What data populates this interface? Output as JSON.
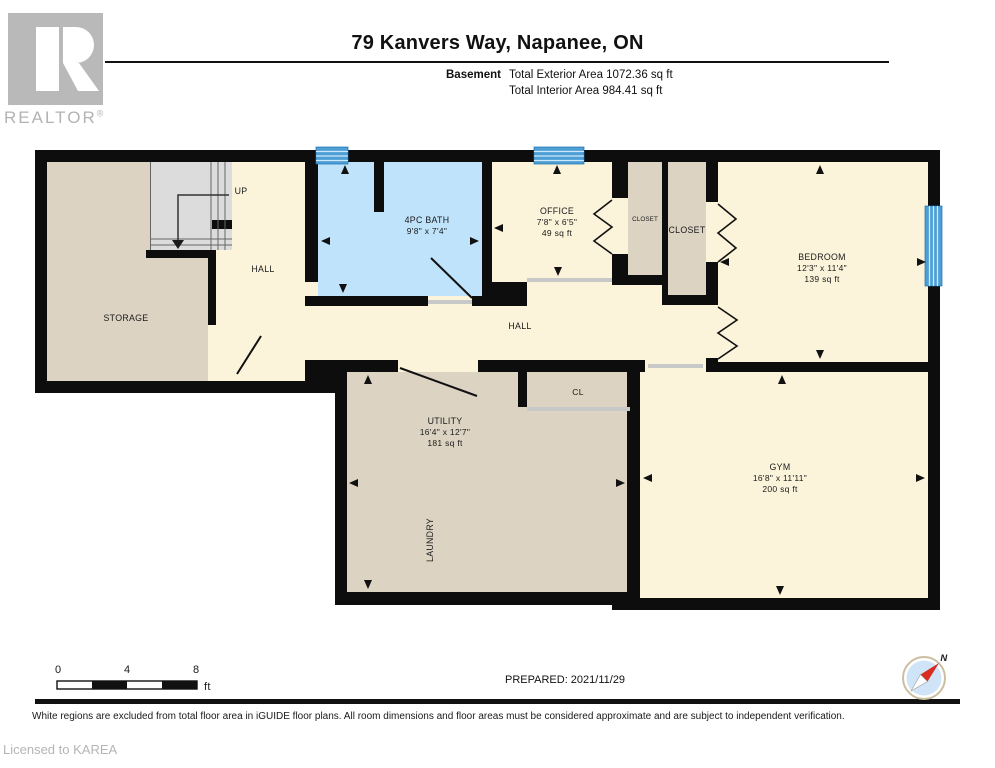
{
  "header": {
    "brand": "REALTOR",
    "registered": "®",
    "title": "79 Kanvers Way, Napanee, ON",
    "floor_label": "Basement",
    "exterior_area": "Total Exterior Area 1072.36 sq ft",
    "interior_area": "Total Interior Area 984.41 sq ft"
  },
  "rooms": {
    "storage": {
      "name": "STORAGE"
    },
    "stairs": {
      "direction": "UP"
    },
    "hall_upper": {
      "name": "HALL"
    },
    "bath": {
      "name": "4PC BATH",
      "dims": "9'8\" x 7'4\""
    },
    "office": {
      "name": "OFFICE",
      "dims": "7'8\" x 6'5\"",
      "area": "49 sq ft"
    },
    "closet_small": {
      "name": "CLOSET"
    },
    "closet_large": {
      "name": "CLOSET"
    },
    "bedroom": {
      "name": "BEDROOM",
      "dims": "12'3\" x 11'4\"",
      "area": "139 sq ft"
    },
    "hall_main": {
      "name": "HALL"
    },
    "utility": {
      "name": "UTILITY",
      "dims": "16'4\" x 12'7\"",
      "area": "181 sq ft"
    },
    "laundry": {
      "name": "LAUNDRY"
    },
    "closet_cl": {
      "name": "CL"
    },
    "gym": {
      "name": "GYM",
      "dims": "16'8\" x 11'11\"",
      "area": "200 sq ft"
    }
  },
  "scale_bar": {
    "start": "0",
    "mid": "4",
    "end": "8",
    "unit": "ft"
  },
  "compass": {
    "label": "N"
  },
  "footer": {
    "prepared": "PREPARED: 2021/11/29",
    "disclaimer": "White regions are excluded from total floor area in iGUIDE floor plans. All room dimensions and floor areas must be considered approximate and are subject to independent verification.",
    "license": "Licensed to KAREA"
  },
  "colors": {
    "wall": "#0d0d0d",
    "room_cream": "#fbf3da",
    "room_tan": "#dcd3c3",
    "bath_blue": "#bfe3fa",
    "window_blue": "#4d9fd6",
    "stair_gray": "#dcdcdc",
    "threshold_gray": "#c8c8c8",
    "logo_gray": "#b9b9b9"
  }
}
